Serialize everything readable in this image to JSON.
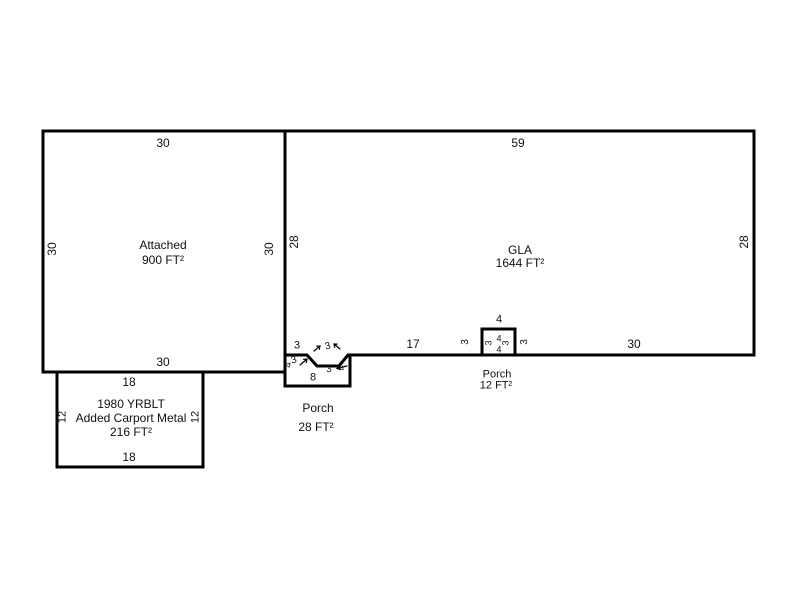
{
  "sketch": {
    "attached": {
      "label": "Attached",
      "area": "900 FT²",
      "top": "30",
      "left": "30",
      "right": "30",
      "bottom": "30"
    },
    "gla": {
      "label": "GLA",
      "area": "1644 FT²",
      "top": "59",
      "left": "28",
      "right": "28",
      "bottom_left_seg": "3",
      "bottom_mid_seg": "17",
      "porch_adj_left": "3",
      "porch_adj_right": "3",
      "bottom_right_seg": "30"
    },
    "front_porch": {
      "label": "Porch",
      "area": "28 FT²",
      "left": "4",
      "diag_left": "3",
      "notch_top": "3",
      "notch_bottom": "3",
      "diag_right": "4",
      "bottom": "8"
    },
    "small_porch": {
      "label": "Porch",
      "area": "12 FT²",
      "top": "4",
      "inner_left": "3",
      "inner_top": "4",
      "inner_right": "3",
      "inner_bottom": "4"
    },
    "carport": {
      "year_line": "1980 YRBLT",
      "desc_line": "Added Carport Metal",
      "area": "216 FT²",
      "top": "18",
      "left": "12",
      "right": "12",
      "bottom": "18"
    },
    "colors": {
      "line": "#000000",
      "text": "#111111",
      "background": "#ffffff"
    }
  }
}
